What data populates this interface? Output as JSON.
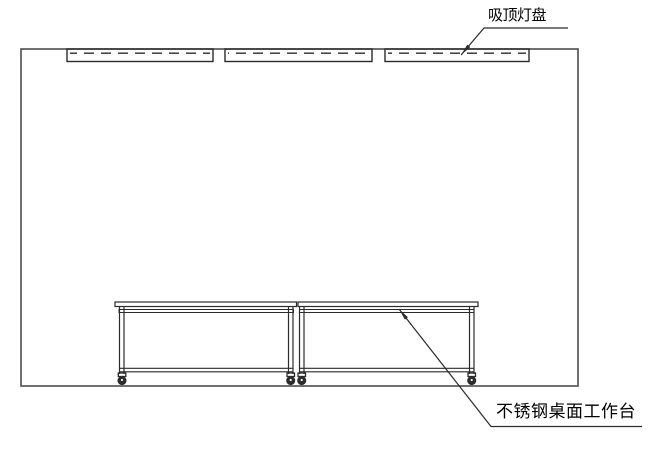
{
  "drawing": {
    "labels": {
      "ceiling_lamp": "吸顶灯盘",
      "workbench": "不锈钢桌面工作台"
    },
    "colors": {
      "background": "#ffffff",
      "line": "#2b2b2b",
      "wall-line": "#4d4d4d",
      "text": "#000000"
    }
  }
}
